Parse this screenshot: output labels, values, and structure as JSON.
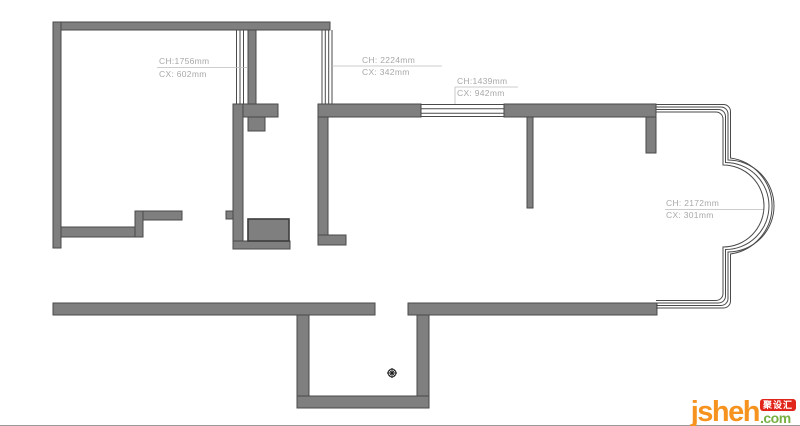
{
  "drawing": {
    "type": "floor-plan",
    "annotations": [
      {
        "ch": "CH:1756mm",
        "cx": "CX: 602mm"
      },
      {
        "ch": "CH: 2224mm",
        "cx": "CX: 342mm"
      },
      {
        "ch": "CH:1439mm",
        "cx": "CX: 942mm"
      },
      {
        "ch": "CH: 2172mm",
        "cx": "CX: 301mm"
      }
    ]
  },
  "logo": {
    "name": "jsheh",
    "tld": ".com",
    "badge": "聚设汇"
  },
  "colors": {
    "wall": "#7f7f7f",
    "outline": "#4a4a4a",
    "annotation": "#a8a8a8",
    "leader": "#bcbcbc",
    "logo_orange": "#f6921e",
    "logo_green": "#76b043",
    "logo_red": "#e1251b"
  }
}
